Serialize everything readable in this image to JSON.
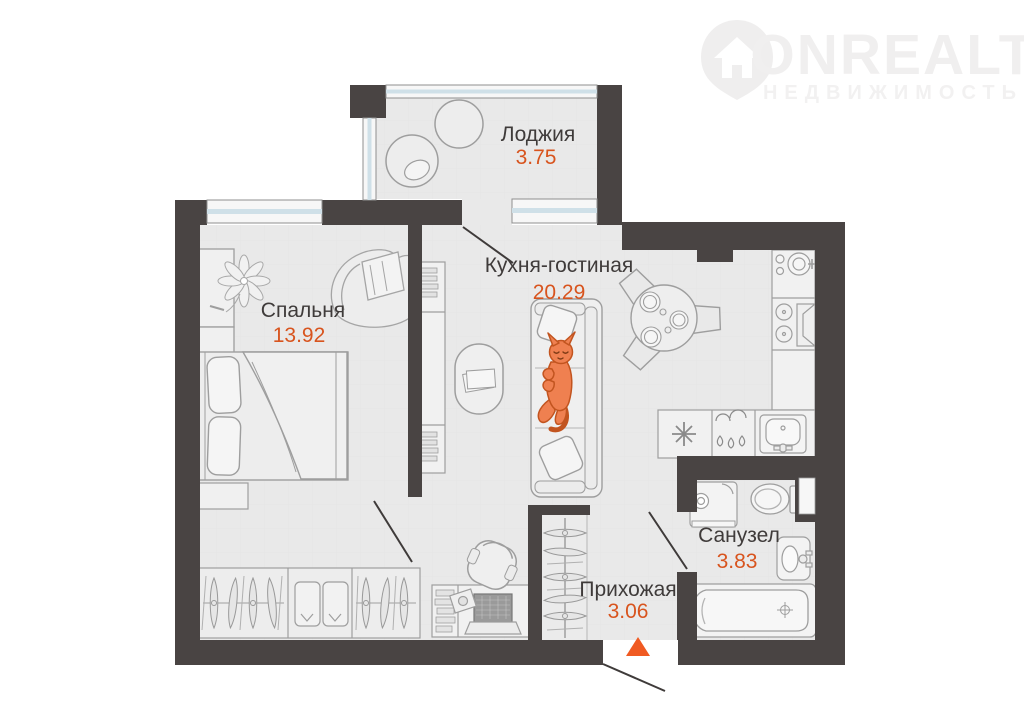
{
  "watermark": {
    "brand": "ONREALT",
    "subtitle": "НЕДВИЖИМОСТЬ"
  },
  "plan": {
    "rooms": [
      {
        "id": "loggia",
        "name": "Лоджия",
        "area": "3.75"
      },
      {
        "id": "kitchen-living",
        "name": "Кухня-гостиная",
        "area": "20.29"
      },
      {
        "id": "bedroom",
        "name": "Спальня",
        "area": "13.92"
      },
      {
        "id": "bathroom",
        "name": "Санузел",
        "area": "3.83"
      },
      {
        "id": "hallway",
        "name": "Прихожая",
        "area": "3.06"
      }
    ],
    "colors": {
      "wall": "#494443",
      "floor": "#e9e9e9",
      "room_label": "#3f3b3a",
      "area_value": "#d8541e",
      "window_glass": "#cfe0e8",
      "window_frame": "#f7f7f7",
      "furniture_line": "#9e9e9e",
      "cat": "#ef8050",
      "cat_outline": "#c2541f",
      "entrance_marker": "#f05a22",
      "watermark_gray": "#f0efef"
    }
  }
}
